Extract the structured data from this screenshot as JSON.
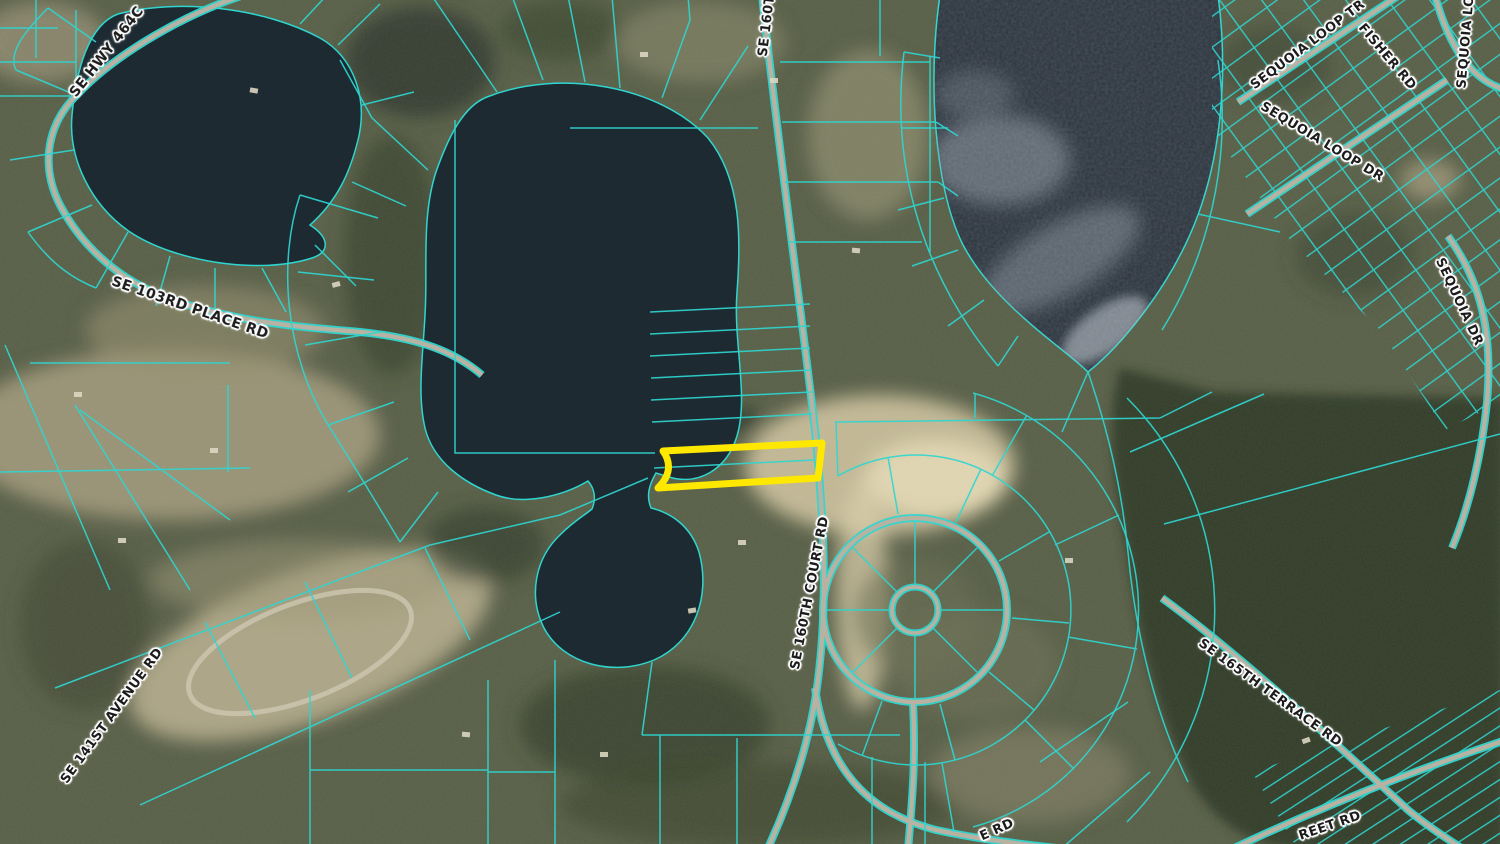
{
  "map": {
    "description": "Aerial parcel map with cyan lot boundaries and a yellow highlighted parcel beside a lake",
    "colors": {
      "parcel_line": "#2fd6d0",
      "highlight_outline": "#ffe800",
      "label_text": "#1c1c1c",
      "label_halo": "#ffffff",
      "water": "#1d2a31",
      "road": "#b7b2a2"
    },
    "labels": [
      {
        "id": "se-hwy-464c",
        "text": "SE HWY 464C"
      },
      {
        "id": "se-103rd-place-rd",
        "text": "SE 103RD PLACE RD"
      },
      {
        "id": "se-160t-partial",
        "text": "SE 160T"
      },
      {
        "id": "se-160th-court-rd",
        "text": "SE 160TH COURT RD"
      },
      {
        "id": "sequoia-loop-tr",
        "text": "SEQUOIA LOOP TR"
      },
      {
        "id": "fisher-rd",
        "text": "FISHER RD"
      },
      {
        "id": "sequoia-lo-partial",
        "text": "SEQUOIA LO"
      },
      {
        "id": "sequoia-loop-dr",
        "text": "SEQUOIA LOOP DR"
      },
      {
        "id": "sequoia-dr",
        "text": "SEQUOIA DR"
      },
      {
        "id": "se-141st-avenue-rd",
        "text": "SE 141ST AVENUE RD"
      },
      {
        "id": "se-165th-terrace-rd",
        "text": "SE 165TH TERRACE RD"
      },
      {
        "id": "e-rd-partial",
        "text": "E RD"
      },
      {
        "id": "street-rd-partial",
        "text": "REET RD"
      }
    ],
    "highlighted_parcel": {
      "outline_color": "#ffe800"
    }
  }
}
